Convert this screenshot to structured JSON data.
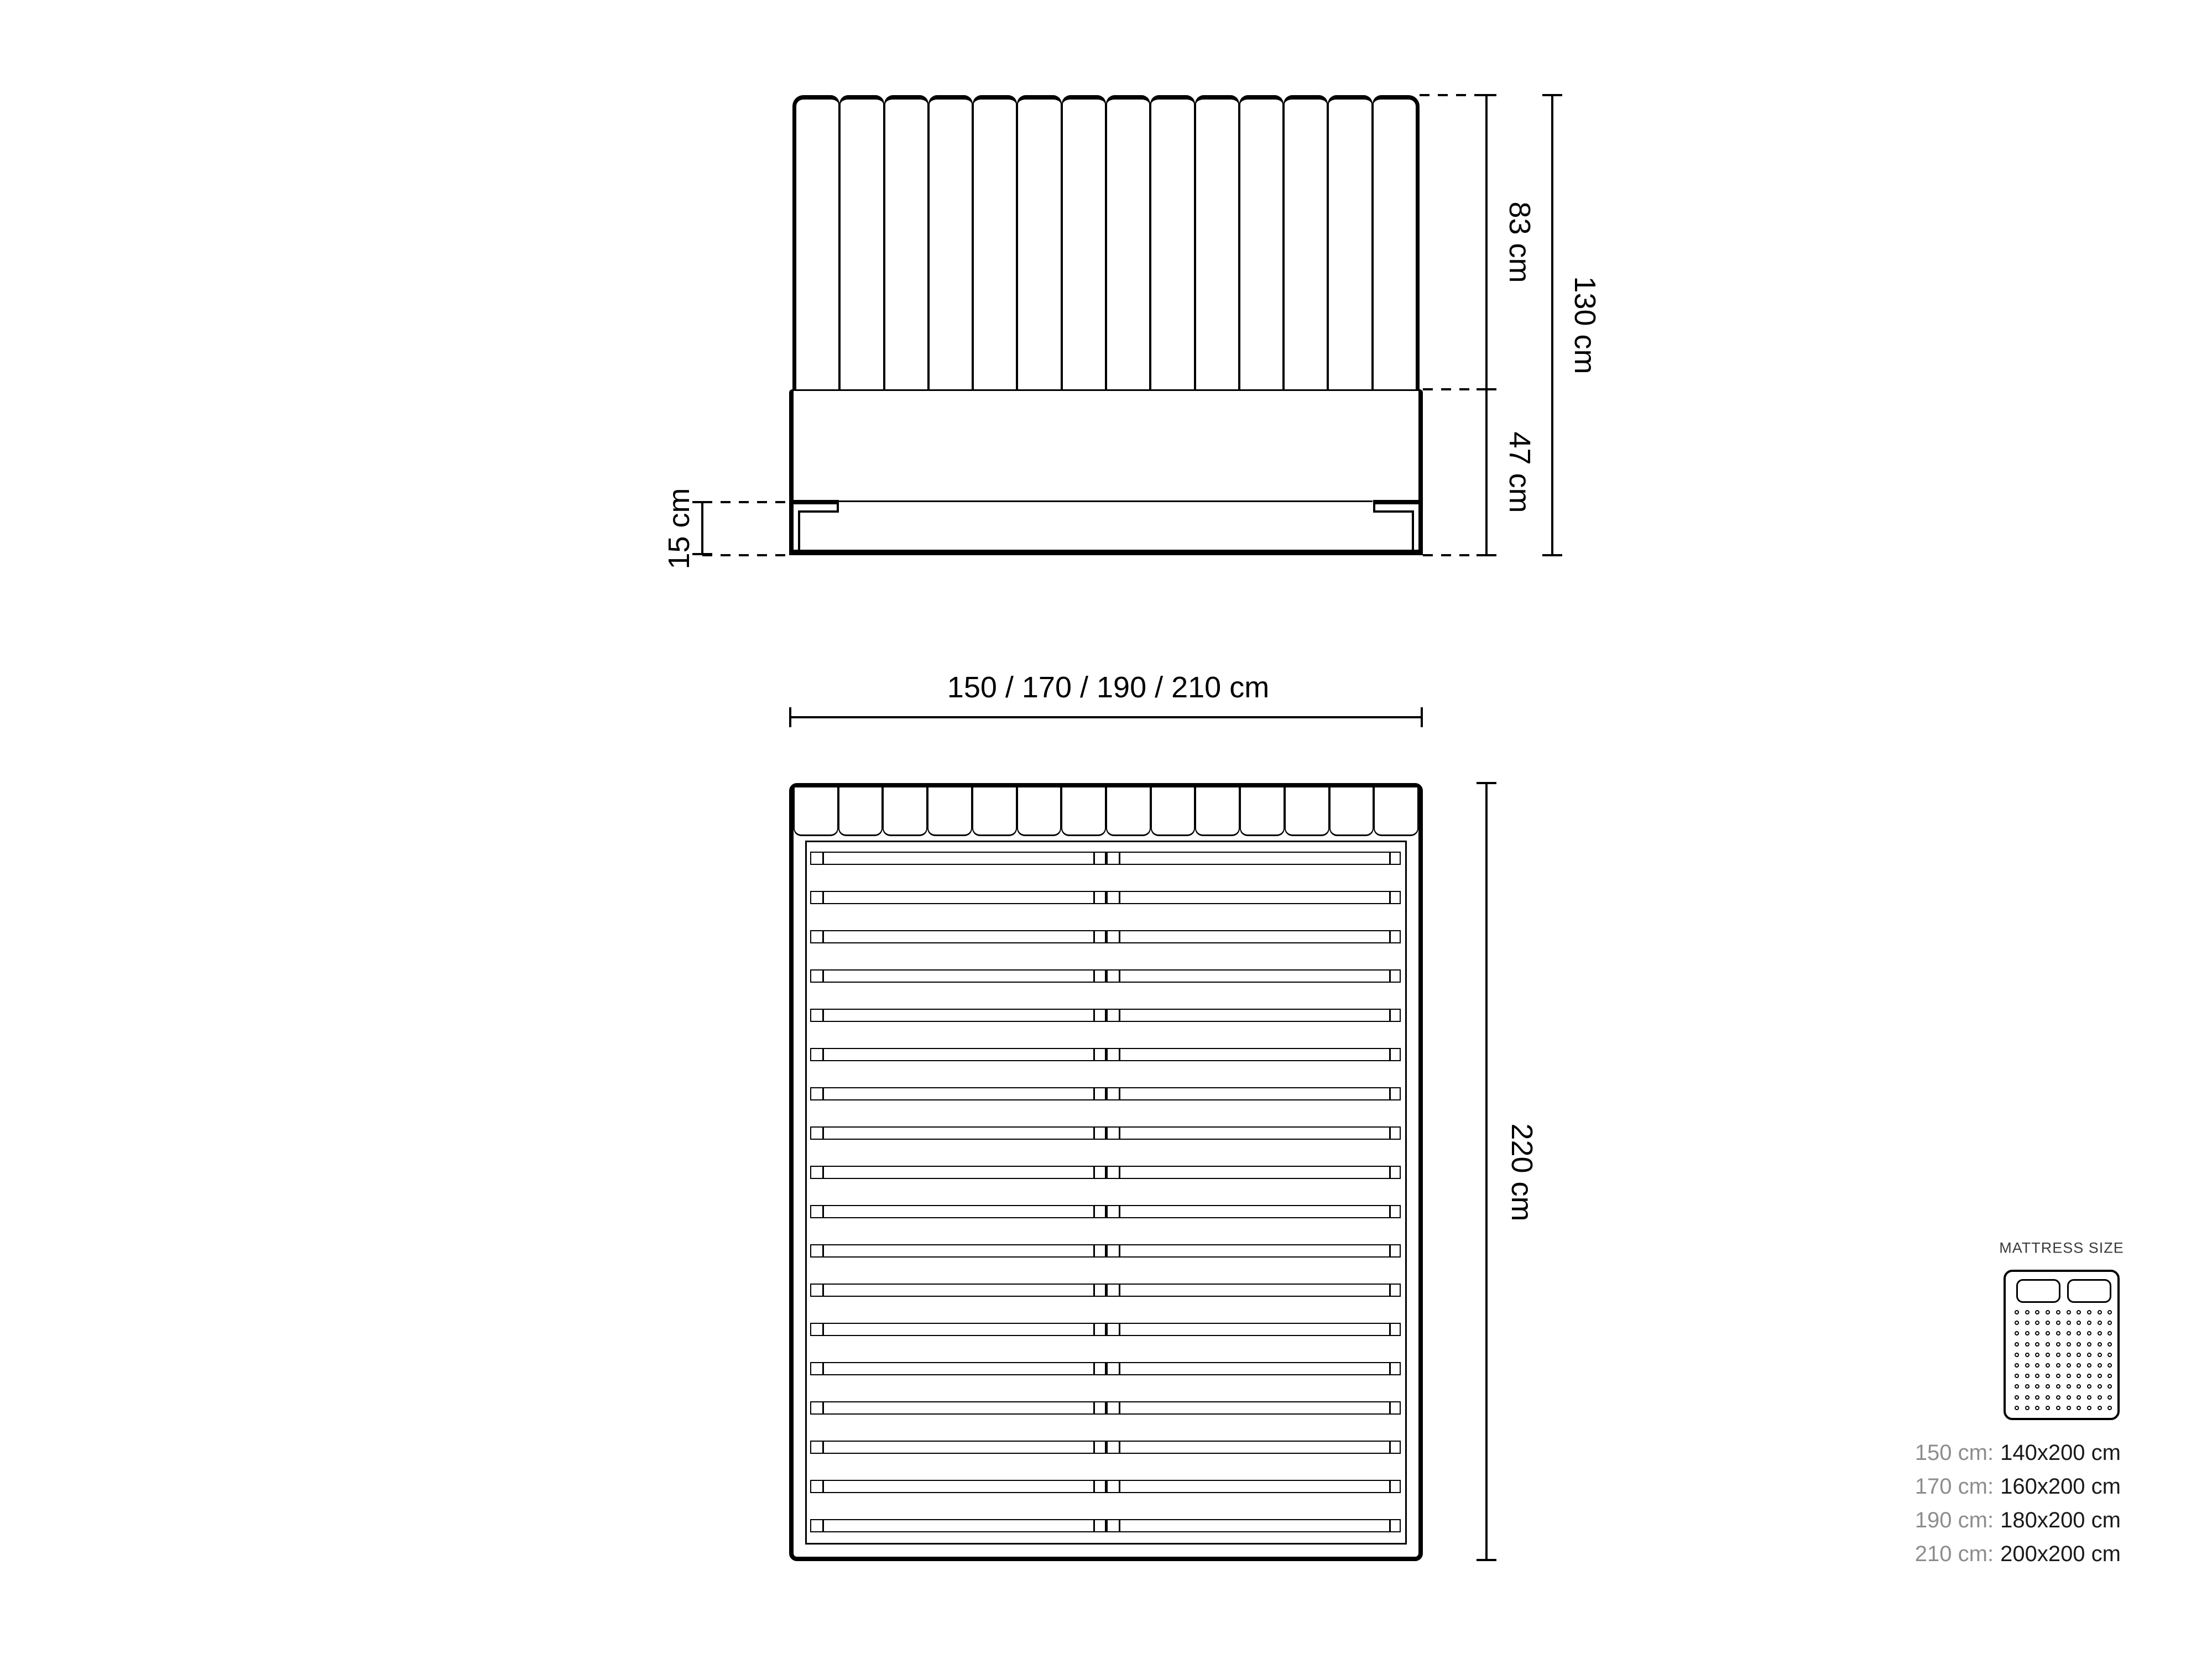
{
  "front_view": {
    "headboard_channels": 14,
    "dims": {
      "headboard_height": "83 cm",
      "base_height": "47 cm",
      "total_height": "130 cm",
      "leg_height": "15 cm"
    }
  },
  "top_view": {
    "headboard_segments": 14,
    "slat_count": 18,
    "dims": {
      "width_options": "150 / 170 / 190 / 210  cm",
      "length": "220 cm"
    }
  },
  "legend": {
    "title": "MATTRESS SIZE",
    "icon": {
      "pillows": 2,
      "dot_rows": 10,
      "dot_cols": 10
    },
    "rows": [
      {
        "size": "150 cm:",
        "mattress": "140x200 cm"
      },
      {
        "size": "170 cm:",
        "mattress": "160x200 cm"
      },
      {
        "size": "190 cm:",
        "mattress": "180x200 cm"
      },
      {
        "size": "210 cm:",
        "mattress": "200x200 cm"
      }
    ]
  },
  "colors": {
    "line": "#000000",
    "legend_title": "#3a3a3a",
    "size_prefix_gray": "#8d8d8d",
    "size_value_black": "#1a1a1a",
    "background": "#ffffff"
  }
}
